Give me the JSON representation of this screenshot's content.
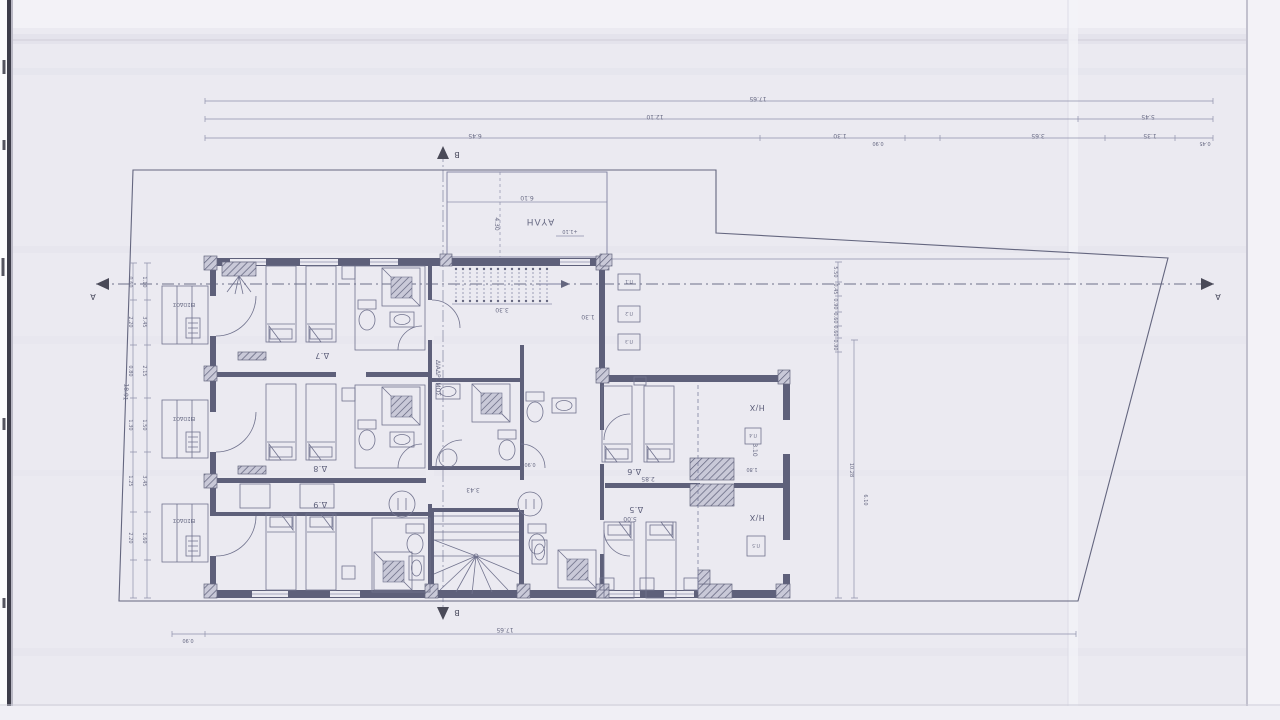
{
  "labels": {
    "courtyard": "ΑΥΛΗ",
    "corridor": "ΔΙΑΔΡΟΜΟΣ",
    "entrance": "ΕΙΣΟΔΟΣ",
    "semi_open": "Η/Χ",
    "room_5": "Δ.5",
    "room_6": "Δ.6",
    "room_7": "Δ.7",
    "room_8": "Δ.8",
    "room_9": "Δ.9",
    "section_a": "A",
    "section_b": "B",
    "level_stamp": "+1.10"
  },
  "window_tags": [
    "Π.1",
    "Π.2",
    "Π.3",
    "Π.4",
    "Π.5"
  ],
  "dims": {
    "top": [
      "17.65",
      "12.10",
      "5.45",
      "6.45",
      "1.30",
      "0.90",
      "3.65",
      "1.35",
      "0.45"
    ],
    "bottom": [
      "0.90",
      "17.65"
    ],
    "left_outer": [
      "0.60",
      "2.20",
      "0.80",
      "1.30",
      "1.25",
      "2.20"
    ],
    "left_inner": [
      "1.10",
      "3.45",
      "2.15",
      "1.50",
      "3.45",
      "1.60"
    ],
    "right": [
      "5.50",
      "0.45",
      "0.90",
      "0.60",
      "0.60",
      "0.90",
      "10.28",
      "6.10"
    ],
    "boundary_left": "18.91",
    "courtyard": [
      "6.10",
      "4.30"
    ],
    "interior": [
      "3.30",
      "1.30",
      "3.85",
      "3.43",
      "0.90",
      "5.00",
      "2.85",
      "3.10",
      "1.80"
    ]
  },
  "colors": {
    "paper": "#ebeaf1",
    "ink": "#6f718c",
    "wall": "#5e607a"
  }
}
